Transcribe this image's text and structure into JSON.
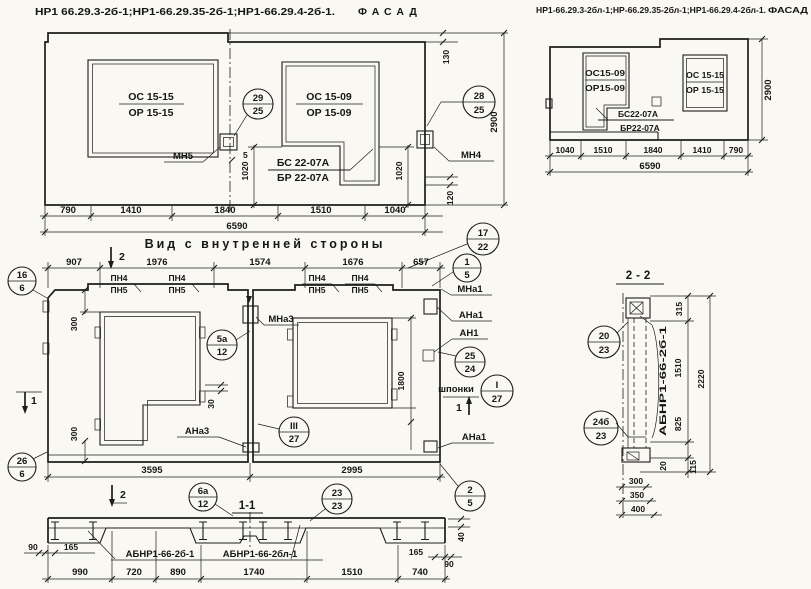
{
  "colors": {
    "paper": "#f9f8f3",
    "ink": "#1c1c1c"
  },
  "titles": {
    "left_codes": "НР1 66.29.3-2б-1;НР1-66.29.35-2б-1;НР1-66.29.4-2б-1.",
    "left_word": "ФАСАД",
    "right_codes": "НР1-66.29.3-2бл-1;НР-66.29.35-2бл-1;НР1-66.29.4-2бл-1.",
    "right_word": "ФАСАД"
  },
  "facade": {
    "win1_top": "ОС 15-15",
    "win1_bot": "ОР 15-15",
    "win2_top": "ОС 15-09",
    "win2_bot": "ОР 15-09",
    "beam_top": "БС 22-07А",
    "beam_bot": "БР 22-07А",
    "mn5": "МН5",
    "mn4": "МН4",
    "b29_top": "29",
    "b29_bot": "25",
    "b28_top": "28",
    "b28_bot": "25",
    "d790": "790",
    "d1410": "1410",
    "d1840": "1840",
    "d1510": "1510",
    "d1040": "1040",
    "total": "6590",
    "h2900": "2900",
    "d130": "130",
    "d120": "120",
    "d1020l": "1020",
    "d1020r": "1020",
    "d5": "5"
  },
  "facade_r": {
    "win1_top": "ОС15-09",
    "win1_bot": "ОР15-09",
    "win2_top": "ОС 15-15",
    "win2_bot": "ОР 15-15",
    "beam_top": "БС22-07А",
    "beam_bot": "БР22-07А",
    "d1040": "1040",
    "d1510": "1510",
    "d1840": "1840",
    "d1410": "1410",
    "d790": "790",
    "total": "6590",
    "h2900": "2900"
  },
  "inner": {
    "title": "Вид с внутренней стороны",
    "d907": "907",
    "d1976": "1976",
    "d1574": "1574",
    "d1676": "1676",
    "d657": "657",
    "pn_top": "ПН4",
    "pn_bot": "ПН5",
    "mna3": "МНа3",
    "mna1": "МНа1",
    "ana1": "АНа1",
    "an1": "АН1",
    "shponki": "шпонки",
    "ana3": "АНа3",
    "ana1b": "АНа1",
    "b16_top": "16",
    "b16_bot": "6",
    "b26_top": "26",
    "b26_bot": "6",
    "b17_top": "17",
    "b17_bot": "22",
    "b15_top": "1",
    "b15_bot": "5",
    "b5a_top": "5а",
    "b5a_bot": "12",
    "b25_top": "25",
    "b25_bot": "24",
    "bI_top": "I",
    "bI_bot": "27",
    "bIII_top": "III",
    "bIII_bot": "27",
    "b6a_top": "6а",
    "b6a_bot": "12",
    "b23_top": "23",
    "b23_bot": "23",
    "b2_top": "2",
    "b2_bot": "5",
    "d300t": "300",
    "d300b": "300",
    "d30": "30",
    "d1800": "1800",
    "d3595": "3595",
    "d2995": "2995",
    "sec1": "1",
    "sec2": "2",
    "sec11": "1-1"
  },
  "sec11": {
    "label_l": "АБНР1-66-2б-1",
    "label_r": "АБНР1-66-2бл-1",
    "d90l": "90",
    "d165l": "165",
    "d990": "990",
    "d720": "720",
    "d890": "890",
    "d1740": "1740",
    "d1510": "1510",
    "d740": "740",
    "d165r": "165",
    "d90r": "90",
    "d40": "40"
  },
  "sec22": {
    "title": "2-2",
    "label": "АБНР1-66-2б-1",
    "b20_top": "20",
    "b20_bot": "23",
    "b24_top": "24б",
    "b24_bot": "23",
    "d315": "315",
    "d1510": "1510",
    "d2220": "2220",
    "d825": "825",
    "d20": "20",
    "d115": "115",
    "d300": "300",
    "d350": "350",
    "d400": "400"
  }
}
